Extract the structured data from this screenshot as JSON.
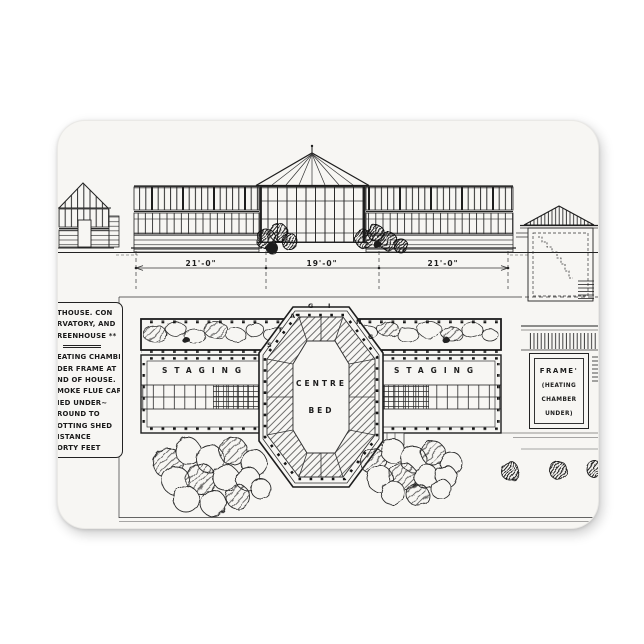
{
  "product": {
    "colors": {
      "page_bg": "#ffffff",
      "magnet_face": "#f7f6f3",
      "ink": "#1c1c1c"
    }
  },
  "elevation": {
    "dimension_labels": [
      "21'-0\"",
      "19'-0\"",
      "21'-0\""
    ]
  },
  "plan": {
    "staging_left_label": "STAGING",
    "staging_right_label": "STAGING",
    "centre_bed": {
      "line1": "CENTRE",
      "line2": "BED"
    },
    "octagon_staging_letters": [
      "S",
      "T",
      "A",
      "G",
      "I",
      "N",
      "G"
    ],
    "frame_box": {
      "lines": [
        "FRAME'",
        "(HEATING",
        "CHAMBER",
        "UNDER)"
      ]
    }
  },
  "note_block": {
    "title_lines": [
      "THOUSE. CON",
      "RVATORY, AND",
      "REENHOUSE **"
    ],
    "body_lines": [
      "EATING CHAMBER",
      "DER FRAME AT",
      "ND OF HOUSE.",
      "MOKE FLUE CAR",
      "IED UNDER~",
      "ROUND TO",
      "OTTING SHED",
      "ISTANCE",
      "ORTY FEET"
    ]
  }
}
